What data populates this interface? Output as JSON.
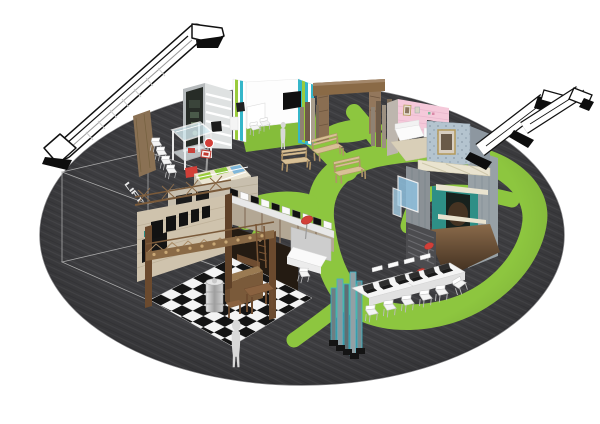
{
  "scene": {
    "description": "3D concept render of a circular exhibition floor",
    "floor_label": "LIFT",
    "object_names": [
      "escalator-left",
      "escalators-right",
      "lift-shaft-wireframe",
      "info-kiosk",
      "cafe-booth",
      "media-booth",
      "shelving-booth",
      "wooden-arch",
      "plank-skyline",
      "pink-lounge-booth",
      "two-story-tower",
      "laptop-tables",
      "garden-benches",
      "mannequins",
      "grass-path-network",
      "round-carpet-floor"
    ],
    "counts": {
      "benches": 3,
      "mannequins": 2,
      "escalators": 3,
      "red_signs": 4,
      "laptops": 6
    }
  },
  "colors": {
    "background": "#ffffff",
    "carpet": "#3d3d40",
    "grass": "#8dc63f",
    "grass_dark": "#85bd3a",
    "wood_bench": "#d8c096",
    "wood_beam": "#8a6a46",
    "cafe_wall": "#cfc3ad",
    "chalkboard": "#141414",
    "pink_wall": "#f5c9da",
    "rug_beige": "#d9cfb8",
    "teal_wall": "#2e8f86",
    "stripe_teal": "#35b6c9",
    "stripe_lime": "#9acb3c",
    "accent_red": "#d23f38",
    "escalator_white": "#ffffff",
    "escalator_trim": "#0d0d0d",
    "mannequin": "#d8d8d8",
    "table_white": "#f5f5f5",
    "laptop_black": "#1a1a1a",
    "dirt_top": "#8a6a4a",
    "dirt_bottom": "#3a2a1c",
    "wallpaper_blue": "#b4c4cf",
    "checker_dark": "#141414",
    "checker_light": "#f4f4f4"
  }
}
